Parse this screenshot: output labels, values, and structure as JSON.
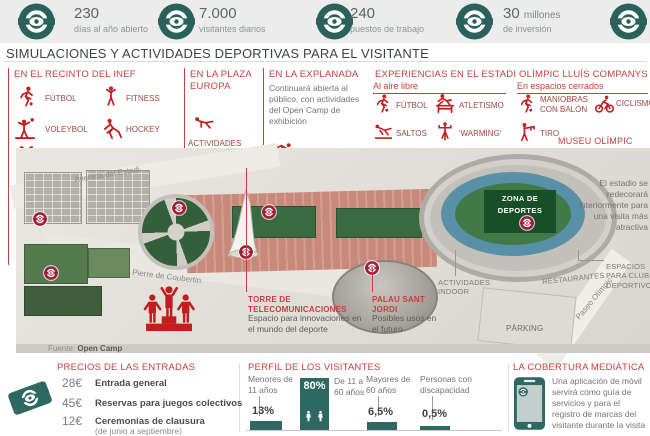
{
  "colors": {
    "teal": "#2e6862",
    "picto_red": "#c41d1e",
    "header_red": "#c5403c",
    "label_red": "#9c4640",
    "marker_red": "#a41e37",
    "field_green": "#174f28"
  },
  "topbar": {
    "stats": [
      {
        "icon": "logo",
        "value": "230",
        "suffix": "",
        "label": "días al año abierto"
      },
      {
        "icon": "logo",
        "value": "7.000",
        "suffix": "",
        "label": "visitantes diarios"
      },
      {
        "icon": "logo",
        "value": "240",
        "suffix": "",
        "label": "puestos de trabajo"
      },
      {
        "icon": "logo",
        "value": "30",
        "suffix": "millones",
        "label": "de inversión"
      }
    ]
  },
  "title": "SIMULACIONES Y ACTIVIDADES DEPORTIVAS PARA EL VISITANTE",
  "sections": {
    "inef": {
      "title": "EN EL RECINTO DEL INEF",
      "items": [
        {
          "icon": "futbol",
          "label": "FÚTBOL"
        },
        {
          "icon": "fitness",
          "label": "FITNESS"
        },
        {
          "icon": "voleybol",
          "label": "VOLEYBOL"
        },
        {
          "icon": "hockey",
          "label": "HOCKEY"
        },
        {
          "icon": "infantil",
          "label": "ZONA INFANTIL"
        }
      ]
    },
    "plaza": {
      "title": "EN LA PLAZA EUROPA",
      "icon": "pushup",
      "label": "ACTIVIDADES AL AIRE LIBRE"
    },
    "explanada": {
      "title": "EN LA EXPLANADA",
      "body": "Continuará abierta al público, con actividades del Open Camp de exhibición",
      "icon": "natacion",
      "label": "ACTIVIDADES RELACIONADAS CON EL AGUA"
    },
    "estadi": {
      "title": "EXPERIENCIAS EN EL ESTADI OLÍMPIC LLUÍS COMPANYS",
      "outdoor": {
        "title": "Al aire libre",
        "items": [
          {
            "icon": "futbol",
            "label": "FÚTBOL"
          },
          {
            "icon": "atletismo",
            "label": "ATLETISMO"
          },
          {
            "icon": "saltos",
            "label": "SALTOS"
          },
          {
            "icon": "warming",
            "label": "'WARMING'"
          },
          {
            "icon": "pesas",
            "label": "PESAS"
          }
        ]
      },
      "indoor": {
        "title": "En espacios cerrados",
        "items": [
          {
            "icon": "balon",
            "label": "MANIOBRAS CON BALÓN"
          },
          {
            "icon": "ciclismo",
            "label": "CICLISMO"
          },
          {
            "icon": "tiro",
            "label": "TIRO"
          }
        ]
      },
      "museu": {
        "title": "MUSEU OLÍMPIC",
        "body": "Se potencia su uso e instalaciones"
      }
    }
  },
  "map": {
    "street_avenida": "Avenida del Estadi",
    "street_coubertin": "Pierre de Coubertin",
    "street_paseo": "Paseo Olímpic",
    "zona_box": "ZONA DE DEPORTES",
    "label_indoor": "ACTIVIDADES INDOOR",
    "label_restaurantes": "RESTAURANTES",
    "label_parking": "PÀRKING",
    "label_espacios": "ESPACIOS PARA CLUBS DEPORTIVOS",
    "stadium_note": "El estadio se redecorará interiormente para una visita más atractiva",
    "torre": {
      "title": "TORRE DE TELECOMUNICACIONES",
      "body": "Espacio para innovaciones en el mundo del deporte"
    },
    "palau": {
      "title": "PALAU SANT JORDI",
      "body": "Posibles usos en el futuro"
    },
    "source_label": "Fuente:",
    "source": "Open Camp"
  },
  "precios": {
    "title": "PRECIOS DE LAS ENTRADAS",
    "icon": "ticket",
    "rows": [
      {
        "price": "28€",
        "label": "Entrada general",
        "note": ""
      },
      {
        "price": "45€",
        "label": "Reservas para juegos colectivos",
        "note": ""
      },
      {
        "price": "12€",
        "label": "Ceremonias de clausura",
        "note": "(de junio a septiembre)"
      }
    ]
  },
  "perfil": {
    "title": "PERFIL DE LOS VISITANTES",
    "bars": [
      {
        "label": "Menores de 11 años",
        "value": "13%"
      },
      {
        "label": "De 11 a 60 años",
        "value": "80%"
      },
      {
        "label": "Mayores de 60 años",
        "value": "6,5%"
      },
      {
        "label": "Personas con discapacidad",
        "value": "0,5%"
      }
    ]
  },
  "chart_data": {
    "type": "bar",
    "categories": [
      "Menores de 11 años",
      "De 11 a 60 años",
      "Mayores de 60 años",
      "Personas con discapacidad"
    ],
    "values": [
      13,
      80,
      6.5,
      0.5
    ],
    "title": "PERFIL DE LOS VISITANTES",
    "xlabel": "",
    "ylabel": "% de visitantes",
    "ylim": [
      0,
      100
    ],
    "legend": false,
    "grid": false
  },
  "cobertura": {
    "title": "LA COBERTURA MEDIÁTICA",
    "icon": "phone",
    "body": "Una aplicación de móvil servirá como guía de servicios y para el registro de marcas del visitante durante la visita"
  }
}
